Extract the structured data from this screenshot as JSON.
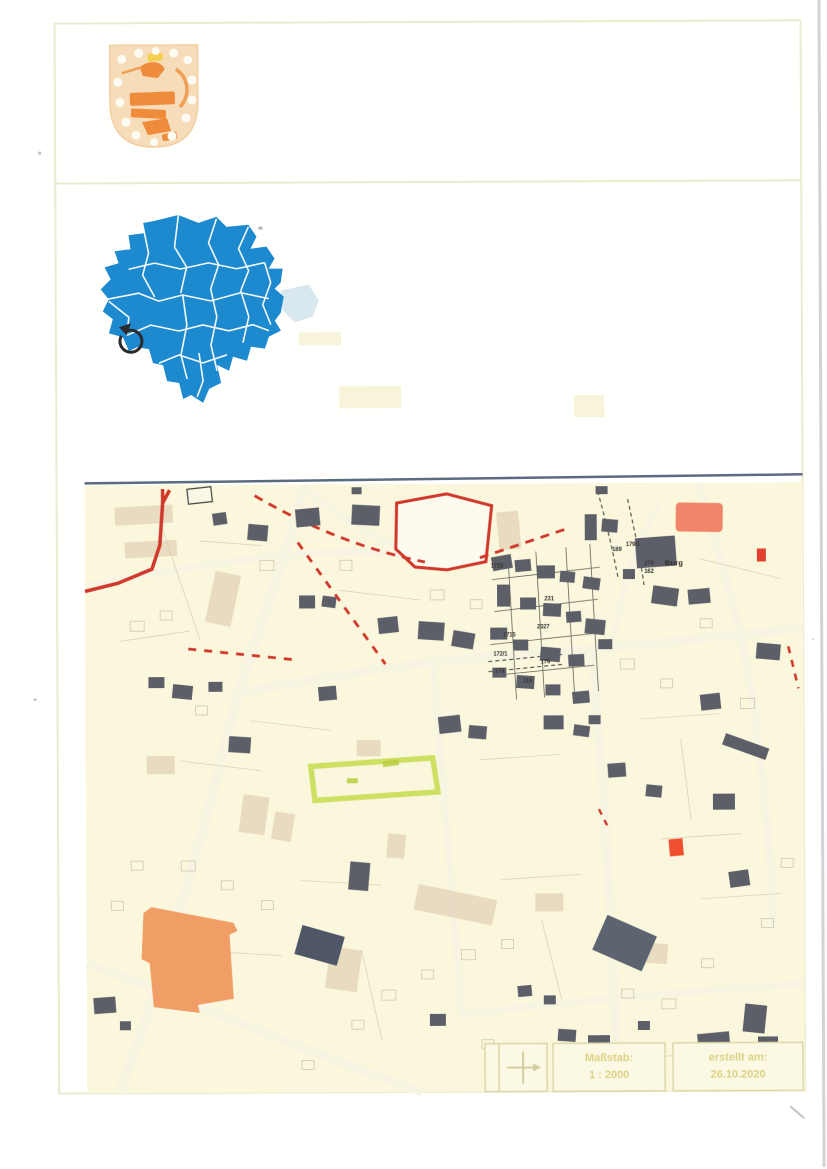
{
  "document": {
    "kind": "scanned municipal map sheet",
    "sections": [
      "header-with-coat-of-arms",
      "district-overview-map",
      "cadastral-city-map",
      "footer-info-strip"
    ]
  },
  "header": {
    "coat_of_arms_name": "coat-of-arms-shield-with-lion-and-stars"
  },
  "overview_map": {
    "description": "blue district map with white municipality borders",
    "marker_name": "location-ring-marker"
  },
  "main_map": {
    "place_labels": [
      {
        "text": "Burg"
      }
    ],
    "parcel_labels": [
      {
        "text": "1718"
      },
      {
        "text": "231"
      },
      {
        "text": "2327"
      },
      {
        "text": "1715"
      },
      {
        "text": "172/1"
      },
      {
        "text": "178"
      },
      {
        "text": "119"
      },
      {
        "text": "179"
      },
      {
        "text": "189"
      },
      {
        "text": "179/1"
      },
      {
        "text": "279"
      },
      {
        "text": "162"
      }
    ]
  },
  "footer": {
    "compass_icon": "north-arrow-icon",
    "scale_label": "Maßstab:",
    "scale_value": "1 : 2000",
    "created_label": "erstellt am:",
    "created_value": "26.10.2020"
  },
  "colors": {
    "district_blue": "#1d89cf",
    "district_border_white": "#ffffff",
    "map_background": "#faf7dd",
    "boundary_red": "#cf382b",
    "building_gray": "#5d5f68",
    "highlight_green": "#c9dd54",
    "building_orange": "#f19d66",
    "building_salmon": "#f28569",
    "frame_yellow": "#ecead0",
    "faint_text_yellow": "#d9cf7c",
    "shield_peach": "#f7dcba",
    "lion_orange": "#ef8c3c"
  }
}
